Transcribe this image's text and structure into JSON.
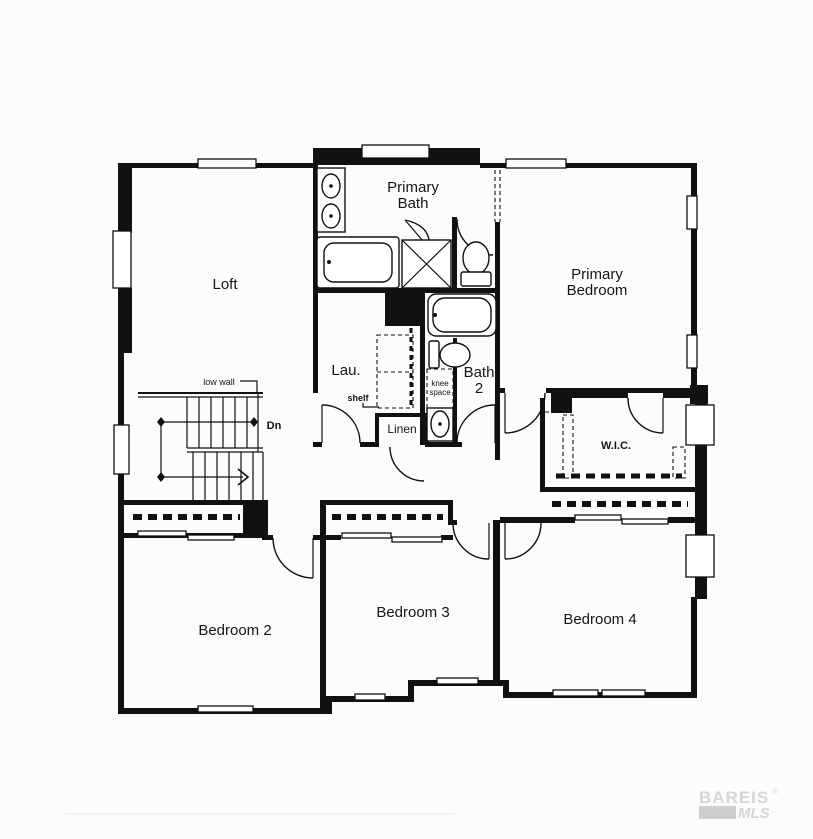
{
  "colors": {
    "wall": "#111111",
    "background": "#fcfcfc",
    "watermark": "#d6d6d6",
    "watermark_block": "#cfcfcf",
    "footer_rule": "#e4e4e4"
  },
  "rooms": {
    "loft": "Loft",
    "primary_bath_1": "Primary",
    "primary_bath_2": "Bath",
    "primary_bedroom_1": "Primary",
    "primary_bedroom_2": "Bedroom",
    "laundry": "Lau.",
    "bath2_1": "Bath",
    "bath2_2": "2",
    "linen": "Linen",
    "wic": "W.I.C.",
    "bedroom2": "Bedroom 2",
    "bedroom3": "Bedroom 3",
    "bedroom4": "Bedroom 4"
  },
  "annotations": {
    "low_wall": "low wall",
    "down": "Dn",
    "shelf": "shelf",
    "knee_1": "knee",
    "knee_2": "space"
  },
  "watermark": {
    "brand": "BAREIS",
    "registered": "®",
    "sub": "MLS"
  }
}
